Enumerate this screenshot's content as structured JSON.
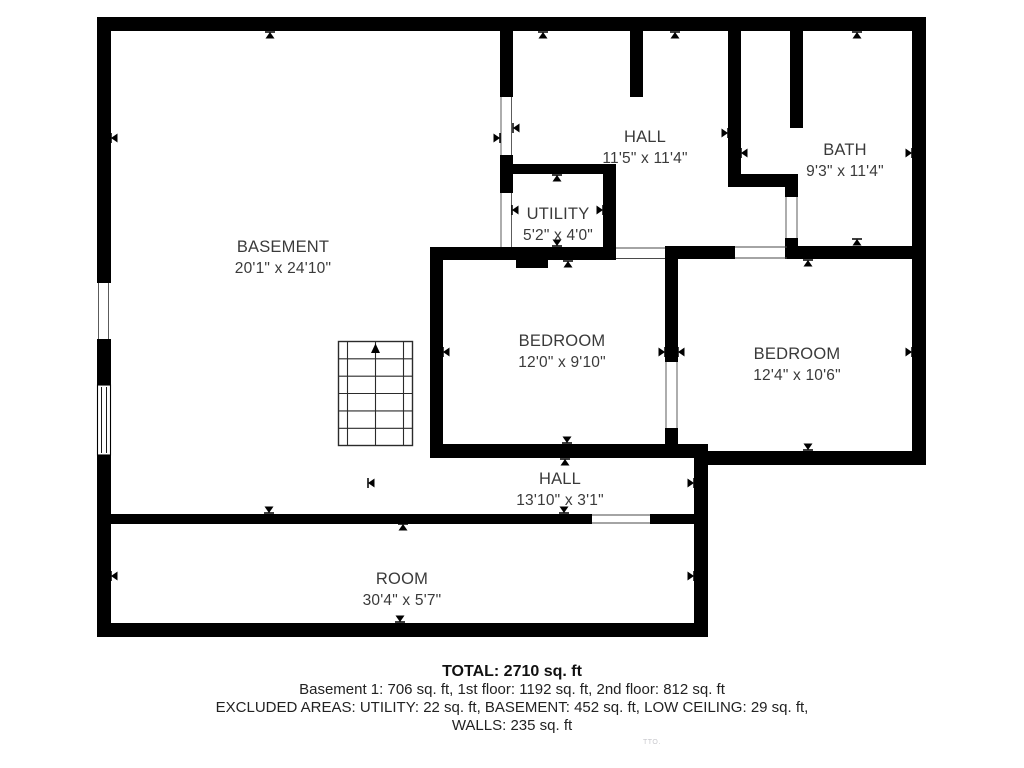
{
  "plan": {
    "rooms": [
      {
        "name": "BASEMENT",
        "dims": "20'1\" x 24'10\""
      },
      {
        "name": "HALL",
        "dims": "11'5\" x 11'4\""
      },
      {
        "name": "BATH",
        "dims": "9'3\" x 11'4\""
      },
      {
        "name": "UTILITY",
        "dims": "5'2\" x 4'0\""
      },
      {
        "name": "BEDROOM",
        "dims": "12'0\" x 9'10\""
      },
      {
        "name": "BEDROOM",
        "dims": "12'4\" x 10'6\""
      },
      {
        "name": "HALL",
        "dims": "13'10\" x 3'1\""
      },
      {
        "name": "ROOM",
        "dims": "30'4\" x 5'7\""
      }
    ],
    "summary": {
      "total": "TOTAL: 2710 sq. ft",
      "floors": "Basement 1: 706 sq. ft, 1st floor: 1192 sq. ft, 2nd floor: 812 sq. ft",
      "excluded": "EXCLUDED AREAS: UTILITY: 22 sq. ft, BASEMENT: 452 sq. ft, LOW CEILING: 29 sq. ft,",
      "walls": "WALLS: 235 sq. ft"
    },
    "watermark": "TTO.",
    "colors": {
      "wall": "#000000",
      "label": "#3a3a3a",
      "summary": "#222222"
    }
  }
}
